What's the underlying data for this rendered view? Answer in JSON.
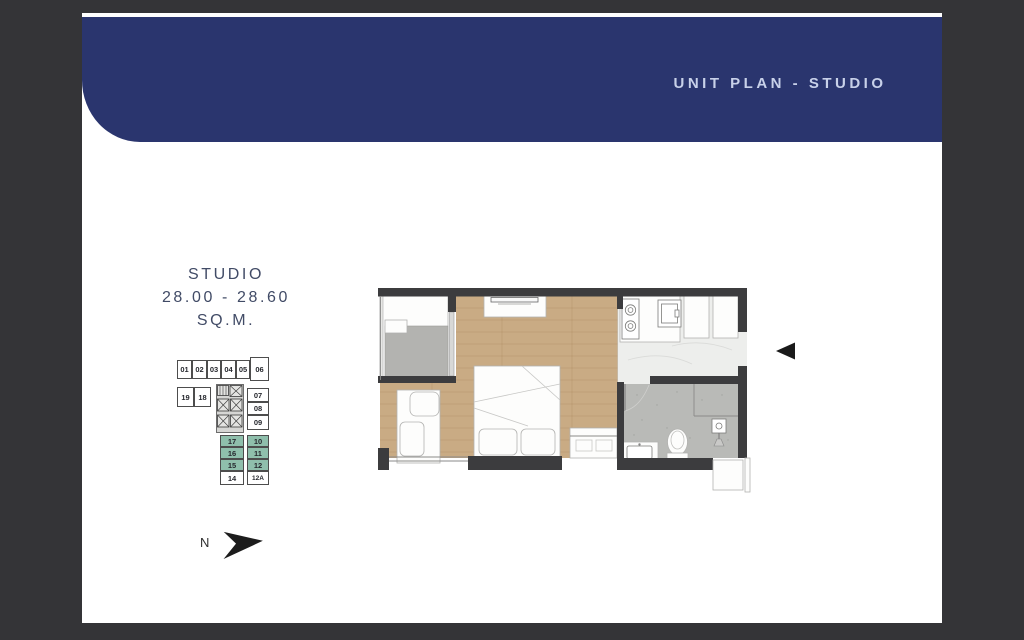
{
  "colors": {
    "outer_bg": "#343437",
    "sheet": "#ffffff",
    "navy": "#2a356e",
    "header_text": "#c8d1e9",
    "info_text": "#414b66",
    "highlight": "#8fbfac",
    "wood": "#c9ab84",
    "wall": "#3c3c3e",
    "tile": "#b9bab7",
    "pad": "#b3b3b0",
    "marble": "#edeeec"
  },
  "header": {
    "title": "UNIT PLAN - STUDIO"
  },
  "unit_info": {
    "type": "STUDIO",
    "area_range": "28.00 - 28.60",
    "unit_suffix": "SQ.M."
  },
  "key_plan": {
    "units": [
      {
        "label": "01",
        "highlighted": false
      },
      {
        "label": "02",
        "highlighted": false
      },
      {
        "label": "03",
        "highlighted": false
      },
      {
        "label": "04",
        "highlighted": false
      },
      {
        "label": "05",
        "highlighted": false
      },
      {
        "label": "06",
        "highlighted": false
      },
      {
        "label": "19",
        "highlighted": false
      },
      {
        "label": "18",
        "highlighted": false
      },
      {
        "label": "07",
        "highlighted": false
      },
      {
        "label": "08",
        "highlighted": false
      },
      {
        "label": "09",
        "highlighted": false
      },
      {
        "label": "17",
        "highlighted": true
      },
      {
        "label": "16",
        "highlighted": true
      },
      {
        "label": "15",
        "highlighted": true
      },
      {
        "label": "14",
        "highlighted": false
      },
      {
        "label": "10",
        "highlighted": true
      },
      {
        "label": "11",
        "highlighted": true
      },
      {
        "label": "12",
        "highlighted": true
      },
      {
        "label": "12A",
        "highlighted": false
      }
    ]
  },
  "compass": {
    "label": "N"
  }
}
